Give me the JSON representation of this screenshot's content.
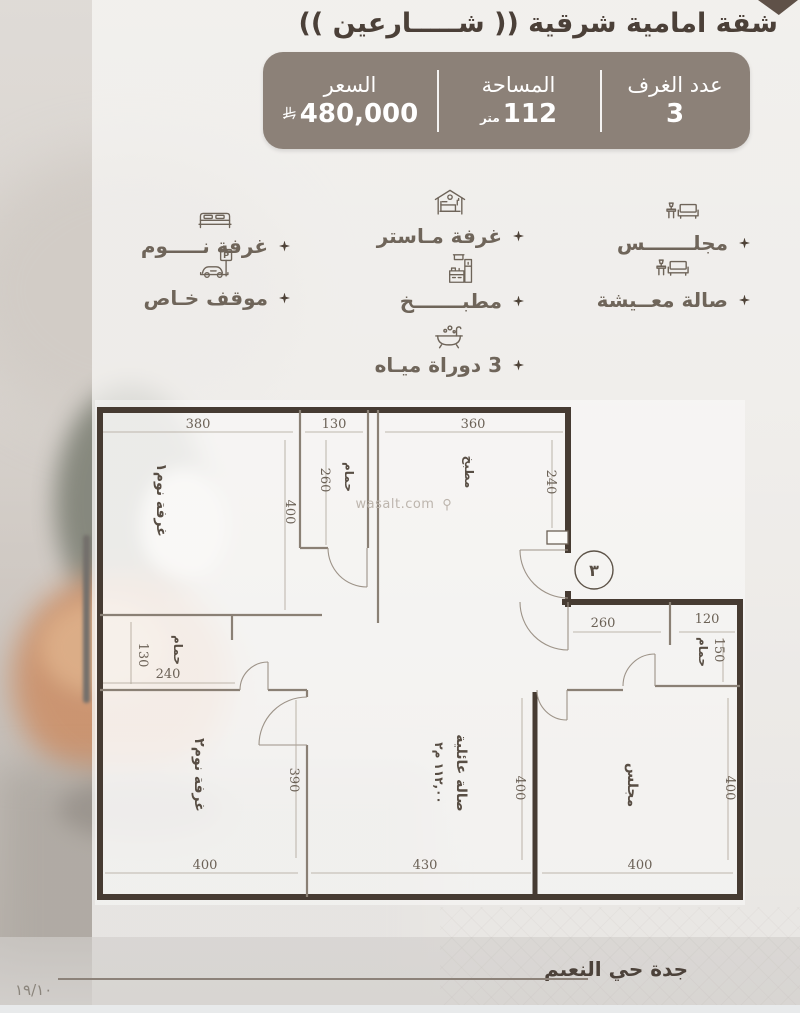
{
  "header": {
    "title": "شقة امامية شرقية (( شـــــارعين ))"
  },
  "summary": {
    "rooms": {
      "label": "عدد الغرف",
      "value": "3"
    },
    "area": {
      "label": "المساحة",
      "value": "112",
      "unit": "متر"
    },
    "price": {
      "label": "السعر",
      "value": "480,000"
    }
  },
  "features": {
    "parking_sign": "P",
    "col_right": [
      {
        "label": "مجلـــــــس"
      },
      {
        "label": "صالة معــيشة"
      }
    ],
    "col_middle": [
      {
        "label": "غرفة مـاستر"
      },
      {
        "label": "مطبـــــــخ"
      },
      {
        "label": "3 دوراة ميـاه"
      }
    ],
    "col_left": [
      {
        "label": "غرفة نـــــوم"
      },
      {
        "label": "موقف خـاص"
      }
    ]
  },
  "floorplan": {
    "watermark": "wasalt.com",
    "entrance_number": "٣",
    "rooms": {
      "bedroom1": "غرفة نوم١",
      "bath_top": "حمام",
      "kitchen": "مطبخ",
      "bath_left": "حمام",
      "bath_right": "حمام",
      "bedroom2": "غرفة نوم٢",
      "family_hall": "صالة عائلية",
      "family_area": "١١٢,٠٠ م٢",
      "majlis": "مجلس"
    },
    "dims": {
      "bedroom1_w": "380",
      "bath_top_w": "130",
      "kitchen_w": "360",
      "bedroom1_h": "400",
      "bath_top_h": "260",
      "kitchen_h": "240",
      "hall_w": "260",
      "bath_right_w": "120",
      "bath_right_h": "150",
      "bath_left_h": "130",
      "bath_left_w": "240",
      "bedroom2_h": "390",
      "bedroom2_w": "400",
      "family_w": "430",
      "family_h": "400",
      "majlis_w": "400",
      "majlis_h": "400"
    }
  },
  "footer": {
    "location": "جدة حي النعيم",
    "date": "١٩/١٠"
  },
  "colors": {
    "panel": "#8c8178",
    "accent": "#5f5148",
    "wall": "#463b32"
  }
}
